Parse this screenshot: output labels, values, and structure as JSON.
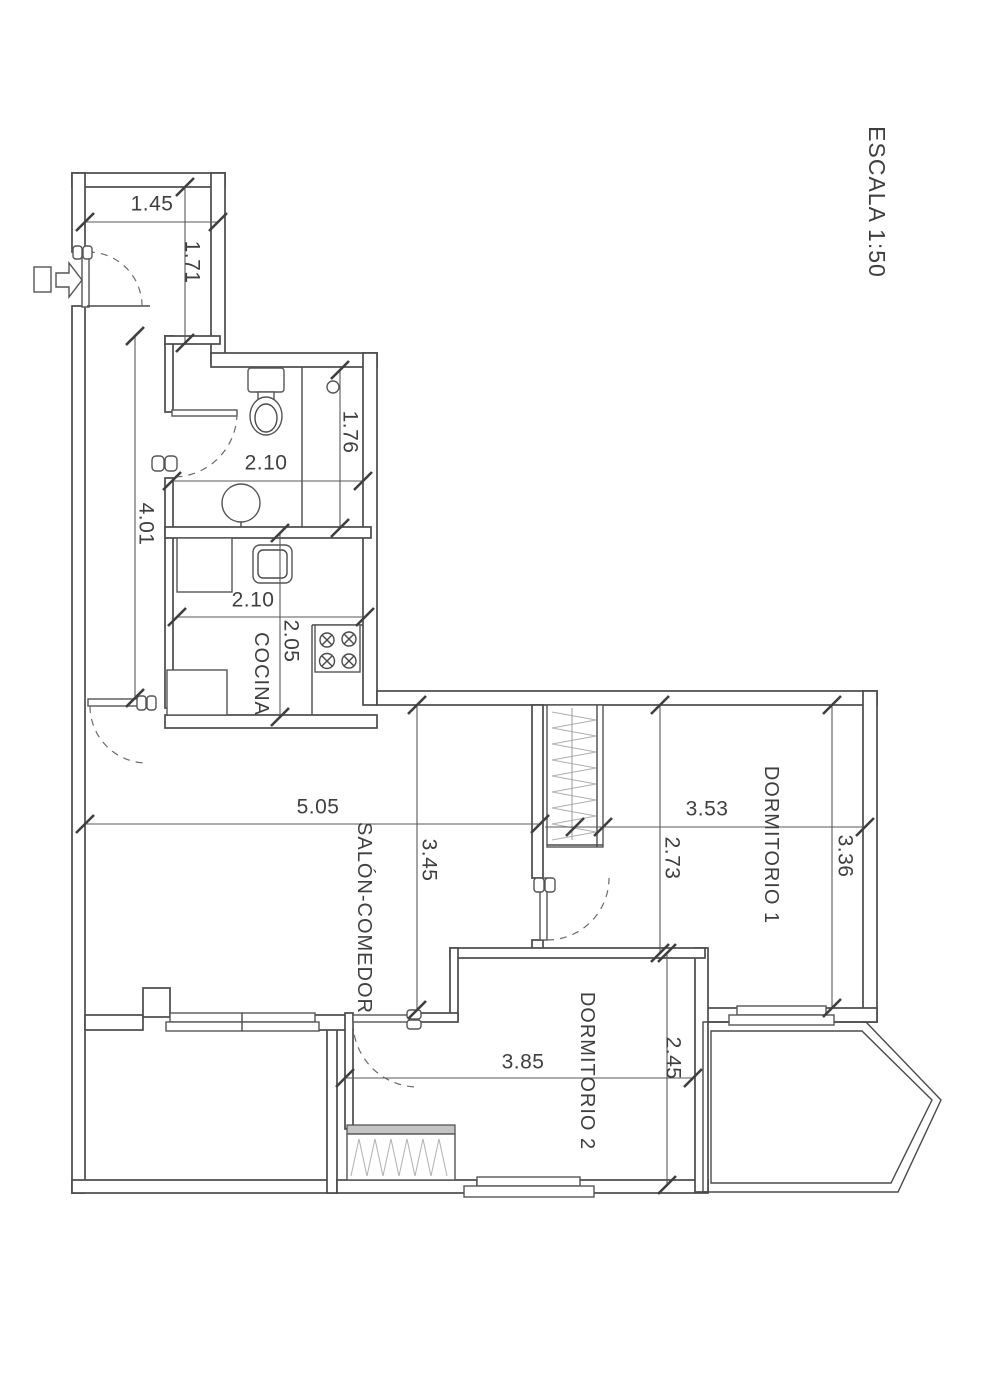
{
  "title": {
    "scale": "ESCALA 1:50"
  },
  "rooms": {
    "kitchen": "COCINA",
    "living": "SALÓN-COMEDOR",
    "bedroom1": "DORMITORIO 1",
    "bedroom2": "DORMITORIO 2"
  },
  "dims": {
    "entry_w": "1.45",
    "entry_d": "1.71",
    "corridor": "4.01",
    "bath_w": "2.10",
    "bath_d": "1.76",
    "kitchen_w": "2.10",
    "kitchen_d": "2.05",
    "living_w": "5.05",
    "living_d": "3.45",
    "bed1_w": "3.53",
    "bed1_d": "3.36",
    "inner_hall_d": "2.73",
    "bed2_w": "3.85",
    "bed2_d": "2.45"
  },
  "icons": {
    "entry_arrow": "entry-direction-arrow"
  },
  "colors": {
    "line": "#4a4a4a",
    "dimension": "#595959",
    "text": "#3f3f3f",
    "hatch": "#b0b0b0",
    "paper": "#ffffff"
  }
}
